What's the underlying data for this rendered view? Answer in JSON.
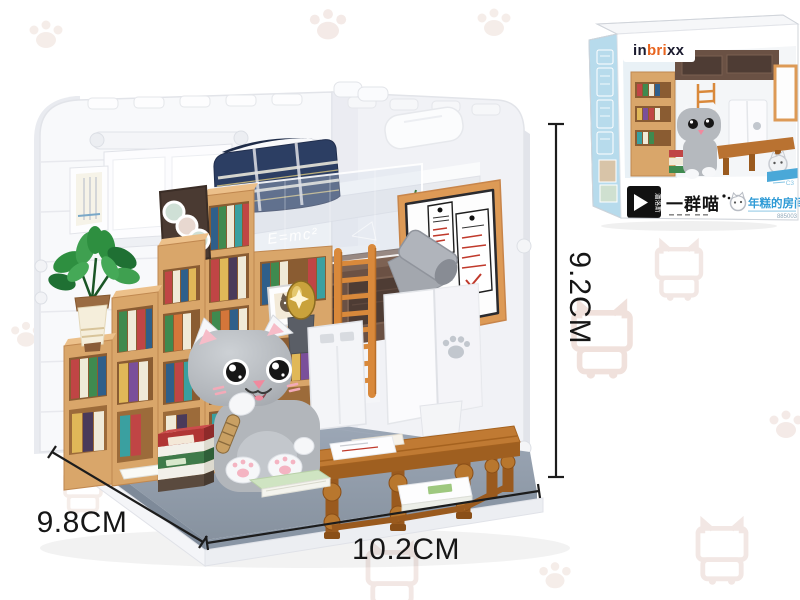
{
  "dimensions": {
    "height": "9.2CM",
    "depth": "9.8CM",
    "width": "10.2CM"
  },
  "model": {
    "railing_text": "E=mc²"
  },
  "box": {
    "brand": {
      "p1": "in",
      "p2": "bri",
      "p3": "xx"
    },
    "maker_logo": "潘洛斯",
    "series_logo": "一群喵",
    "product_name": "年糕的房间",
    "item_number": "885003",
    "corner_mark": "C3"
  },
  "colors": {
    "shelf_wood": "#d9a66a",
    "loft_wood_dark": "#6b5144",
    "blanket_navy": "#2c3e63",
    "cat_grey": "#b2b6bb",
    "floor_grey": "#8e99a8",
    "desk_wood": "#b97231",
    "ladder_orange": "#d9893b",
    "board_frame": "#dd9a56",
    "box_spine_blue": "#b7dbec",
    "product_name_blue": "#2f9bd6",
    "plant_green": "#2e8f40",
    "dimension_text": "#161616",
    "watermark": "#f0e3df"
  }
}
